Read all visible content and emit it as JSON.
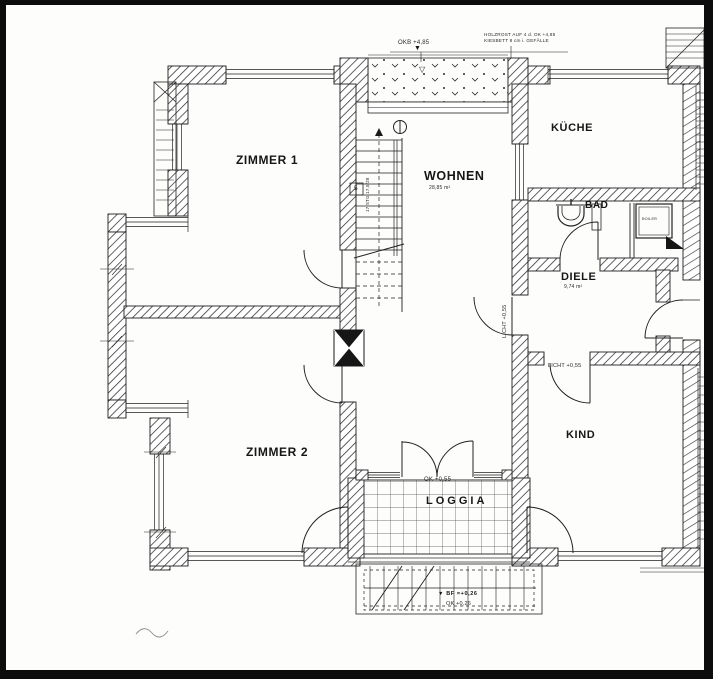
{
  "document": {
    "kind": "Scanned architectural floor plan",
    "language": "German"
  },
  "rooms": {
    "zimmer1": {
      "label": "ZIMMER 1"
    },
    "zimmer2": {
      "label": "ZIMMER 2"
    },
    "wohnen": {
      "label": "WOHNEN",
      "area_note": "28,85 m²"
    },
    "kueche": {
      "label": "KÜCHE"
    },
    "bad": {
      "label": "BAD"
    },
    "diele": {
      "label": "DIELE",
      "area_note": "9,74 m²"
    },
    "kind": {
      "label": "KIND"
    },
    "loggia": {
      "label": "LOGGIA",
      "level_note": "OK +0,55"
    }
  },
  "annotations": {
    "roof_level": "OKB +4,85",
    "roof_note_line1": "HOLZROST AUF 4 d. OK +4,85",
    "roof_note_line2": "KIESBETT 8 cm i. GEFÄLLE",
    "sill_note_west": "LICHT +0,55",
    "sill_note_south": "LICHT +0,55",
    "entry_level_bf": "BF =+0,26",
    "entry_level_ok": "OK +0,26",
    "boiler": "BOILER",
    "stair_note": "17 STG 17,5/28",
    "stair_mark": "5"
  },
  "icons": {
    "level_marker_filled": "▼",
    "level_marker_open": "▽"
  },
  "colors": {
    "paper": "#fdfdfb",
    "ink": "#1a1a1a",
    "frame": "#0c0c0c"
  }
}
